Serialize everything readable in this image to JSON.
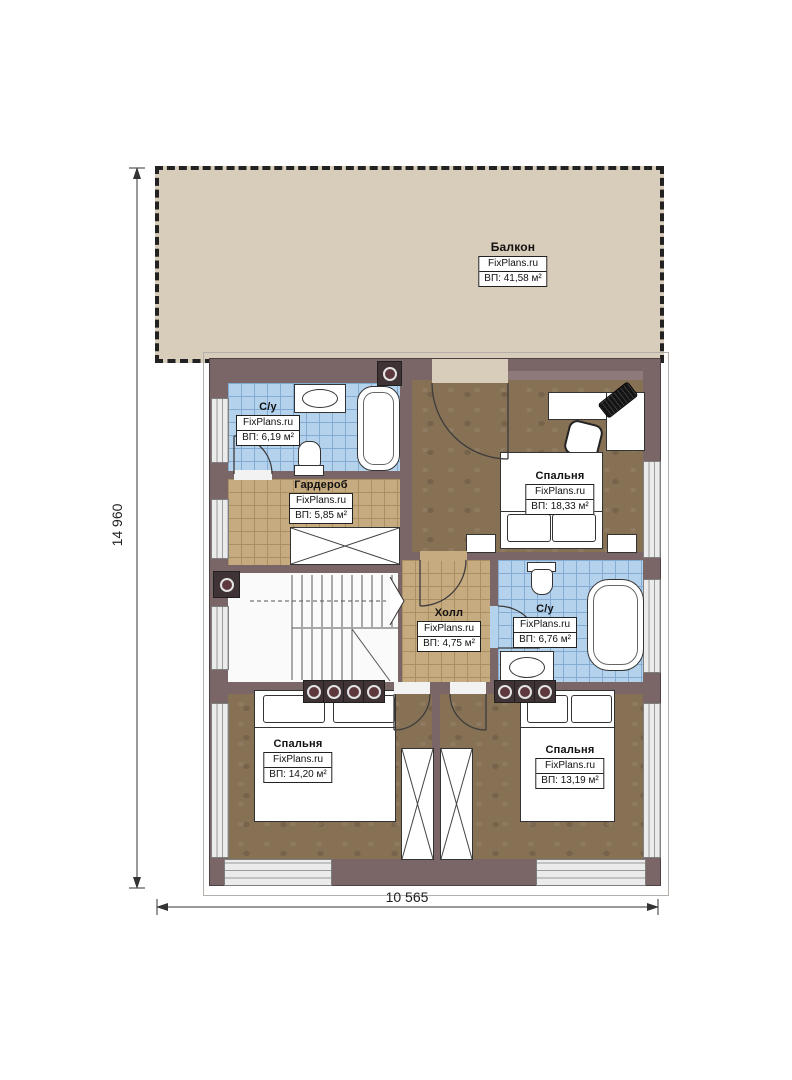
{
  "plan": {
    "watermark": "FixPlans.ru",
    "dimensions": {
      "height": "14 960",
      "width": "10 565"
    },
    "rooms": [
      {
        "key": "balcony",
        "name": "Балкон",
        "area": "ВП: 41,58 м²"
      },
      {
        "key": "bath-top",
        "name": "С/у",
        "area": "ВП: 6,19 м²"
      },
      {
        "key": "wardrobe",
        "name": "Гардероб",
        "area": "ВП: 5,85 м²"
      },
      {
        "key": "bedroom-right",
        "name": "Спальня",
        "area": "ВП: 18,33 м²"
      },
      {
        "key": "hall",
        "name": "Холл",
        "area": "ВП: 4,75 м²"
      },
      {
        "key": "bath-middle",
        "name": "С/у",
        "area": "ВП: 6,76 м²"
      },
      {
        "key": "bedroom-bottom-left",
        "name": "Спальня",
        "area": "ВП: 14,20 м²"
      },
      {
        "key": "bedroom-bottom-right",
        "name": "Спальня",
        "area": "ВП: 13,19 м²"
      }
    ],
    "colors": {
      "wall": "#7a6567",
      "wall_light": "#8e797b",
      "balcony_floor": "#d8ccba",
      "tile_blue": "#b5d2ec",
      "tile_blue_line": "#84abd1",
      "tile_tan": "#c6aa80",
      "tile_tan_line": "#aa8f63",
      "wood_floor": "#877155",
      "window_band": "#ebebeb",
      "vent_square": "#3f3336",
      "vent_circle": "#5d383c",
      "label_border": "#222222"
    }
  }
}
